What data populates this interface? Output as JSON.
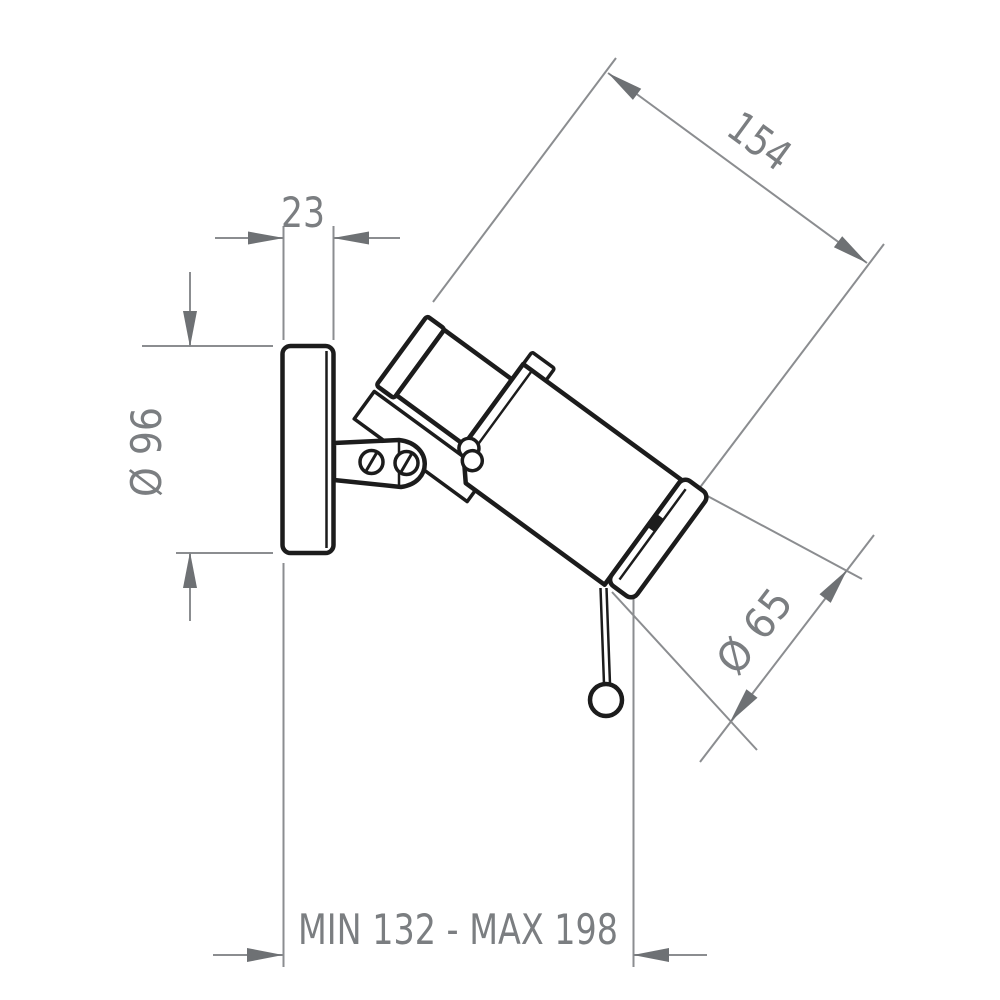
{
  "dimensions": {
    "canopy_depth": "23",
    "canopy_diameter": "Ø 96",
    "body_length": "154",
    "head_diameter": "Ø 65",
    "projection_range": "MIN 132 - MAX 198"
  },
  "colors": {
    "line-black": "#1c1c1c",
    "dim-line": "#8b8d90",
    "dim-arrow": "#6e7174",
    "dim-text": "#7b7e81",
    "background": "#ffffff"
  }
}
